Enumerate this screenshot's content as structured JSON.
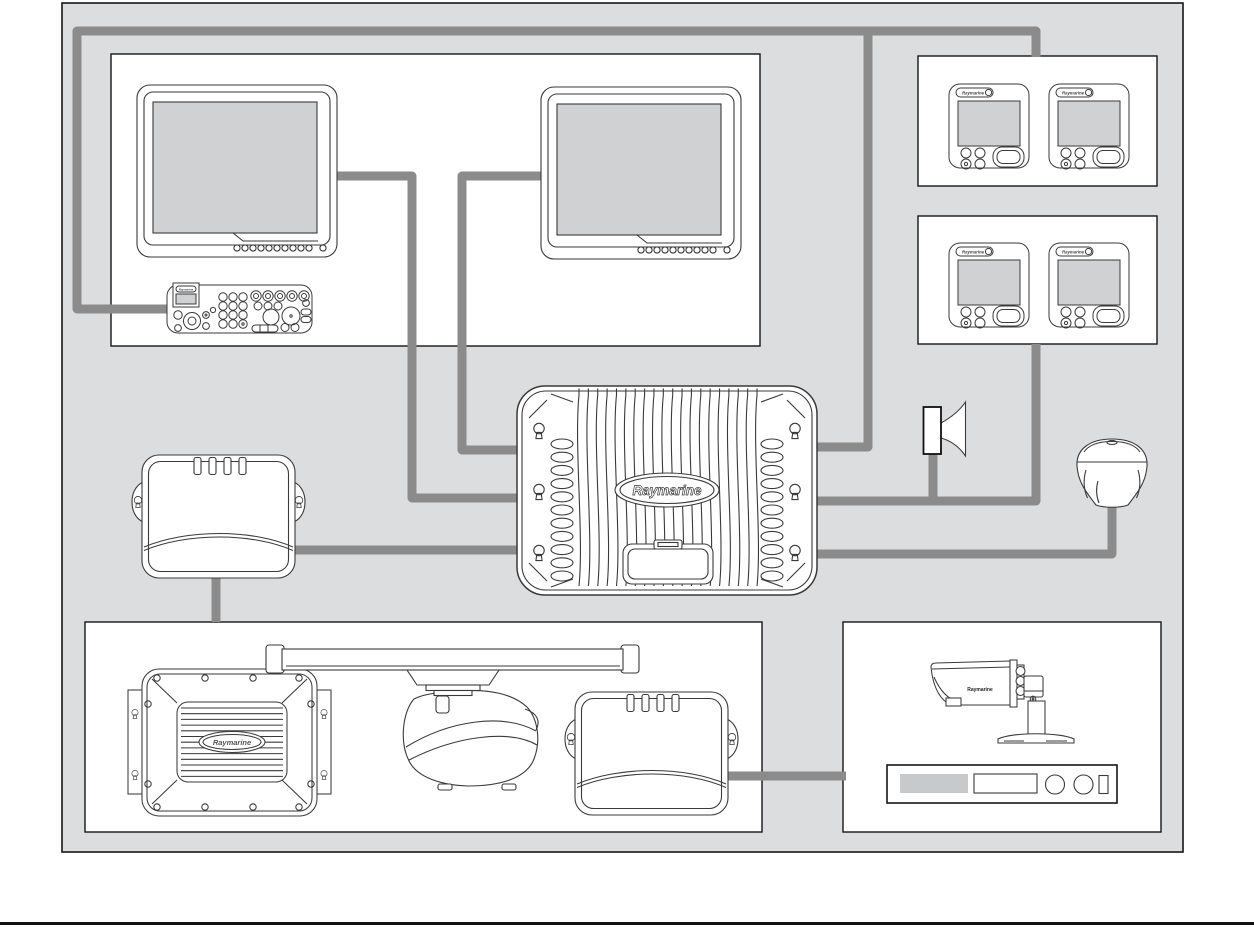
{
  "document": {
    "kind": "marine-electronics-system-interconnection-diagram",
    "brand": "Raymarine"
  },
  "colors": {
    "page_bg": "#ffffff",
    "panel_bg": "#dcddde",
    "panel_border": "#161616",
    "box_bg": "#ffffff",
    "box_border": "#161616",
    "cable": "#8b8b8b",
    "line_art": "#3a3a3a",
    "screen_fill": "#d0d1d3",
    "av_panel_fill": "#c8c9cb",
    "footer_rule": "#111111"
  },
  "labels": {
    "processor": "Raymarine",
    "radar_interface": "Raymarine",
    "camera": "Raymarine",
    "instrument": "Raymarine",
    "keyboard": "Raymarine"
  },
  "devices": [
    {
      "name": "multifunction-display-1",
      "type": "marine display monitor"
    },
    {
      "name": "multifunction-display-2",
      "type": "marine display monitor"
    },
    {
      "name": "keyboard",
      "type": "system keyboard with trackpad and rotary knobs"
    },
    {
      "name": "instrument-display-1",
      "type": "instrument display"
    },
    {
      "name": "instrument-display-2",
      "type": "instrument display"
    },
    {
      "name": "instrument-display-3",
      "type": "instrument display"
    },
    {
      "name": "instrument-display-4",
      "type": "instrument display"
    },
    {
      "name": "processor-unit",
      "type": "system processor unit"
    },
    {
      "name": "sounder-module",
      "type": "sounder/network module"
    },
    {
      "name": "speaker",
      "type": "loudspeaker"
    },
    {
      "name": "gps-antenna",
      "type": "GPS antenna"
    },
    {
      "name": "radar-interface-box",
      "type": "radar interface box"
    },
    {
      "name": "open-array-radar-scanner",
      "type": "open array radar antenna with pedestal"
    },
    {
      "name": "remote-module",
      "type": "remote network module"
    },
    {
      "name": "camera",
      "type": "marine video camera"
    },
    {
      "name": "video-player",
      "type": "video player deck"
    }
  ],
  "groups": [
    {
      "name": "helm-station-box",
      "devices": [
        "multifunction-display-1",
        "multifunction-display-2",
        "keyboard"
      ]
    },
    {
      "name": "instrument-group-1-box",
      "devices": [
        "instrument-display-1",
        "instrument-display-2"
      ]
    },
    {
      "name": "instrument-group-2-box",
      "devices": [
        "instrument-display-3",
        "instrument-display-4"
      ]
    },
    {
      "name": "radar-sonar-box",
      "devices": [
        "radar-interface-box",
        "open-array-radar-scanner",
        "remote-module"
      ]
    },
    {
      "name": "video-box",
      "devices": [
        "camera",
        "video-player"
      ]
    }
  ],
  "cables": [
    {
      "name": "keyboard-to-instrument-bus",
      "from": "keyboard",
      "to": "instrument-group-1",
      "points": "168,309 77,309 77,31 1036,31 1036,57"
    },
    {
      "name": "bus-branch-to-processor",
      "from": "instrument-bus",
      "to": "processor-right-top",
      "points": "868,31 868,447 815,447"
    },
    {
      "name": "instrument-group-2-to-processor",
      "from": "instrument-group-2",
      "to": "processor-right-middle",
      "points": "1036,344 1036,501 815,501"
    },
    {
      "name": "speaker-drop",
      "from": "speaker",
      "to": "processor-cable-junction",
      "points": "933,449 933,501"
    },
    {
      "name": "gps-antenna-to-processor",
      "from": "gps-antenna",
      "to": "processor-right-bottom",
      "points": "1112,504 1112,554 815,554"
    },
    {
      "name": "display-1-to-processor",
      "from": "multifunction-display-1",
      "to": "processor-left-middle",
      "points": "335,176 412,176 412,498 522,498"
    },
    {
      "name": "display-2-to-processor",
      "from": "multifunction-display-2",
      "to": "processor-left-top",
      "points": "547,176 462,176 462,450 522,450"
    },
    {
      "name": "sounder-module-to-processor",
      "from": "sounder-module",
      "to": "processor-left-bottom",
      "points": "290,550 522,550"
    },
    {
      "name": "sounder-module-to-radar-box",
      "from": "sounder-module",
      "to": "radar-sonar-box",
      "points": "216,574 216,622"
    },
    {
      "name": "remote-module-to-av-box",
      "from": "remote-module",
      "to": "video-box",
      "points": "724,776 846,776"
    }
  ]
}
